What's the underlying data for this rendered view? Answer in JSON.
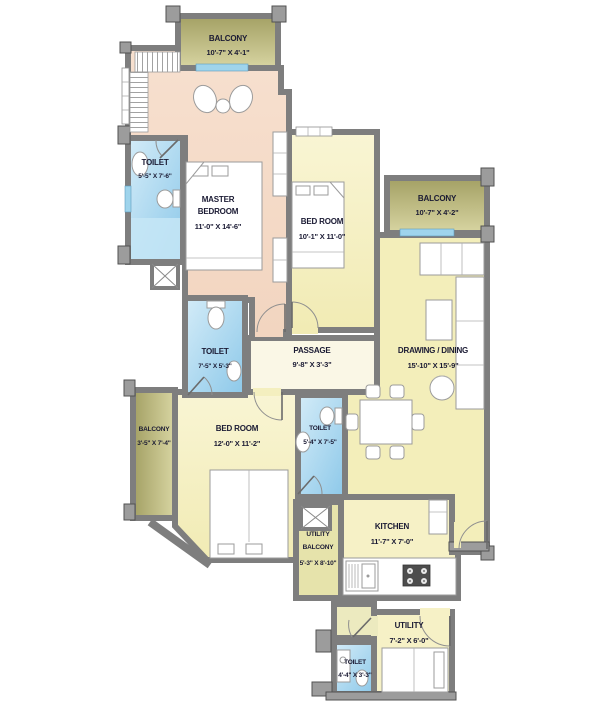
{
  "title": "Apartment Floor Plan",
  "colors": {
    "balcony_olive": "#b5b274",
    "master_peach": "#f5dcc9",
    "room_yellow": "#f6f1c6",
    "drawing_yellow": "#f3eeba",
    "passage_cream": "#faf7e6",
    "toilet_blue": "#a9d6ee",
    "wall_gray": "#7e7e7e"
  },
  "rooms": {
    "balcony_top": {
      "name": "BALCONY",
      "dims": "10'-7\" X 4'-1\""
    },
    "master": {
      "name1": "MASTER",
      "name2": "BEDROOM",
      "dims": "11'-0\" X 14'-6\""
    },
    "toilet_master": {
      "name": "TOILET",
      "dims": "5'-5\" X 7'-6\""
    },
    "bedroom2": {
      "name": "BED ROOM",
      "dims": "10'-1\" X 11'-0\""
    },
    "balcony_right": {
      "name": "BALCONY",
      "dims": "10'-7\" X 4'-2\""
    },
    "toilet_mid": {
      "name": "TOILET",
      "dims": "7'-5\" X 5'-3\""
    },
    "passage": {
      "name": "PASSAGE",
      "dims": "9'-8\" X 3'-3\""
    },
    "drawing": {
      "name": "DRAWING / DINING",
      "dims": "15'-10\" X 15'-9\""
    },
    "balcony_left": {
      "name": "BALCONY",
      "dims": "3'-5\" X 7'-4\""
    },
    "bedroom3": {
      "name": "BED ROOM",
      "dims": "12'-0\" X 11'-2\""
    },
    "toilet_bed3": {
      "name": "TOILET",
      "dims": "5'-4\" X 7'-5\""
    },
    "utility_balcony": {
      "name1": "UTILITY",
      "name2": "BALCONY",
      "dims": "5'-3\" X 8'-10\""
    },
    "kitchen": {
      "name": "KITCHEN",
      "dims": "11'-7\" X 7'-0\""
    },
    "utility": {
      "name": "UTILITY",
      "dims": "7'-2\" X 6'-0\""
    },
    "toilet_utility": {
      "name": "TOILET",
      "dims": "4'-4\" X 3'-3\""
    }
  }
}
